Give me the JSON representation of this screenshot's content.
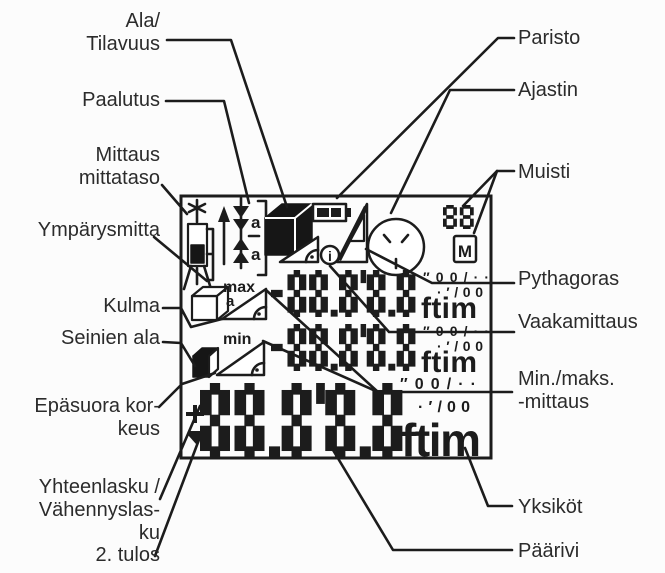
{
  "colors": {
    "ink": "#1c1c1c",
    "background": "#fcfcfc"
  },
  "labels": {
    "left": [
      {
        "id": "area-volume",
        "text": "Ala/\nTilavuus"
      },
      {
        "id": "staking",
        "text": "Paalutus"
      },
      {
        "id": "reference-level",
        "text": "Mittaus\nmittataso"
      },
      {
        "id": "circumference",
        "text": "Ympärysmitta"
      },
      {
        "id": "angle",
        "text": "Kulma"
      },
      {
        "id": "wall-area",
        "text": "Seinien ala"
      },
      {
        "id": "indirect-height",
        "text": "Epäsuora kor-\nkeus"
      },
      {
        "id": "add-subtract",
        "text": "Yhteenlasku /\nVähennyslas-\nku"
      },
      {
        "id": "second-result",
        "text": "2. tulos"
      }
    ],
    "right": [
      {
        "id": "battery",
        "text": "Paristo"
      },
      {
        "id": "timer",
        "text": "Ajastin"
      },
      {
        "id": "memory",
        "text": "Muisti"
      },
      {
        "id": "pythagoras",
        "text": "Pythagoras"
      },
      {
        "id": "horizontal-measure",
        "text": "Vaakamittaus"
      },
      {
        "id": "min-max-measure",
        "text": "Min./maks.\n-mittaus"
      },
      {
        "id": "units",
        "text": "Yksiköt"
      },
      {
        "id": "main-row",
        "text": "Päärivi"
      }
    ]
  },
  "display": {
    "icon_names": [
      "laser-star",
      "reference-device",
      "tripod",
      "up-arrow",
      "staking-arrows",
      "volume-cube",
      "battery",
      "pythagoras-triangles",
      "horizontal-measure-triangle",
      "info-circle",
      "timer-clock",
      "memory-box",
      "wireframe-cube",
      "max-angle-triangle",
      "min-angle-triangle",
      "wall-area-cube",
      "plus-sign",
      "minus-wedge"
    ],
    "staking_letter_top": "a",
    "staking_letter_bottom": "a",
    "max_label": "max",
    "max_sub_letter": "a",
    "min_label": "min",
    "memory_count": "88",
    "memory_letter": "M",
    "info_letter": "i",
    "rows": {
      "secondary1": {
        "digits": "-88.8'8.8",
        "unit": "ftim",
        "frac_top": "″00/··",
        "frac_bottom": "·′/00"
      },
      "secondary2": {
        "digits": "-88.8'8.8",
        "unit": "ftim",
        "frac_top": "″00/··",
        "frac_bottom": "·′/00"
      },
      "main": {
        "digits": "88.8'8.8",
        "unit": "ftim",
        "frac_top": "″00/··",
        "frac_bottom": "·′/00"
      }
    }
  }
}
